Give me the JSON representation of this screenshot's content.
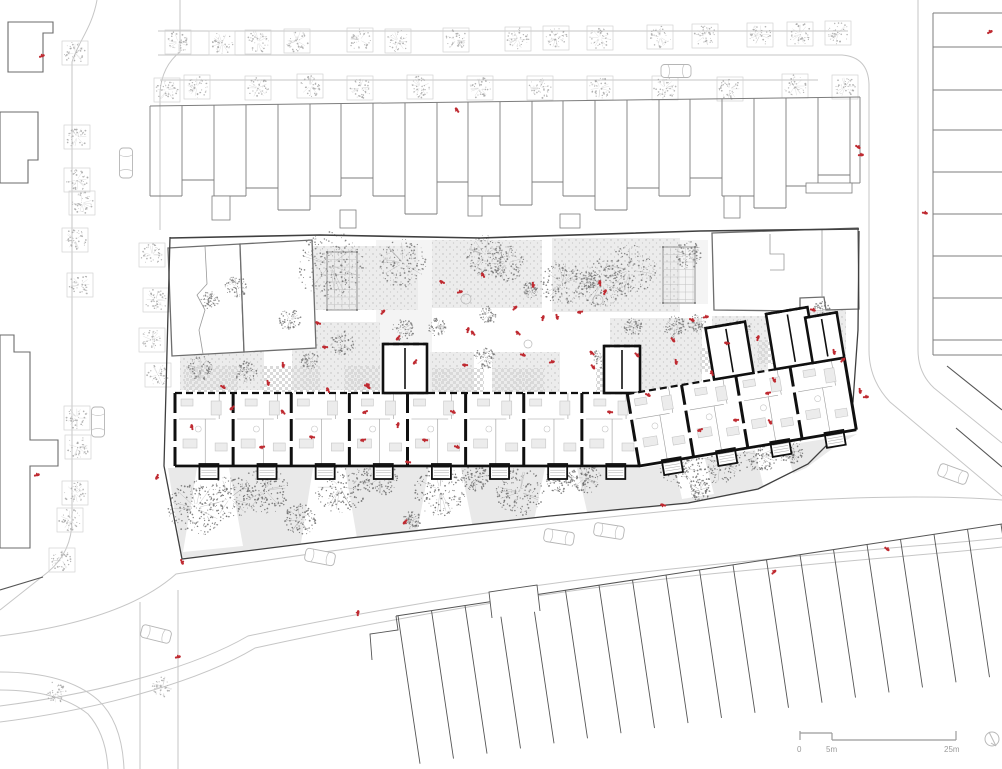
{
  "document": {
    "type": "architectural-site-plan",
    "view": "ground floor site plan"
  },
  "scale_bar": {
    "labels": [
      "0",
      "5m",
      "25m"
    ]
  },
  "north_arrow": {
    "symbol": "compass-circle"
  },
  "colors": {
    "paper": "#ffffff",
    "curb": "#c6c6c6",
    "context_stroke": "#7d7d7d",
    "context_dark": "#555555",
    "boundary": "#3f3f3f",
    "wall": "#101010",
    "interior_line": "#9c9c9c",
    "furniture_fill": "#ececec",
    "furniture_stroke": "#c6c6c6",
    "garden": "#e9e9e9",
    "plot_dot": "#bdbdbd",
    "checker": "#d9d9d9",
    "tree_street": "#a8a8a8",
    "tree_garden": "#787878",
    "accent_red": "#bf2a31",
    "scale_gray": "#9b9b9b"
  },
  "drawing": {
    "streets": {
      "light": [
        "M97,0 C92,28 78,42 72,62 V520 Q72,552 48,572 L0,610",
        "M180,0 V52 Q162,66 160,92 V230",
        "M158,31 H848",
        "M158,55 H842 Q868,57 869,84 V350 Q869,380 890,402 L1002,496",
        "M160,80 H818",
        "M918,0 V350 Q918,373 934,388 L1002,443",
        "M0,636 C80,626 140,606 176,574 C340,548 530,524 700,508 C850,494 950,496 1002,500",
        "M0,706 C110,692 200,664 248,636 C400,604 560,580 700,566 C850,550 950,544 1002,538",
        "M0,722 C110,708 205,678 255,648 C405,615 560,590 700,575 C850,560 950,553 1002,547",
        "M140,602 V769",
        "M178,590 V769",
        "M0,672 Q66,672 98,700 Q122,722 124,769",
        "M0,690 Q58,690 88,714 Q106,734 108,769"
      ],
      "dark": [
        "M947,366 L1002,410",
        "M956,428 L1002,467",
        "M43,577 L0,590"
      ]
    },
    "context": {
      "top_row": {
        "top_left": [
          150,
          106
        ],
        "top_right": [
          860,
          97
        ],
        "units": [
          [
            150,
            196
          ],
          [
            182,
            180
          ],
          [
            214,
            196
          ],
          [
            246,
            188
          ],
          [
            278,
            210
          ],
          [
            310,
            196
          ],
          [
            341,
            178
          ],
          [
            373,
            196
          ],
          [
            405,
            214
          ],
          [
            437,
            182
          ],
          [
            468,
            196
          ],
          [
            500,
            205
          ],
          [
            532,
            182
          ],
          [
            563,
            196
          ],
          [
            595,
            210
          ],
          [
            627,
            188
          ],
          [
            659,
            196
          ],
          [
            690,
            178
          ],
          [
            722,
            196
          ],
          [
            754,
            208
          ],
          [
            786,
            186
          ],
          [
            818,
            175
          ],
          [
            850,
            183
          ]
        ],
        "right_x": 860,
        "extensions": [
          [
            212,
            196,
            18,
            24
          ],
          [
            340,
            210,
            16,
            18
          ],
          [
            468,
            196,
            14,
            20
          ],
          [
            560,
            214,
            20,
            14
          ],
          [
            724,
            196,
            16,
            22
          ],
          [
            806,
            183,
            46,
            10
          ]
        ]
      },
      "left_buildings": [
        "M8,22 H53 V33 H43 V72 H8 Z",
        "M0,112 H38 V160 H28 V183 H0 Z",
        "M0,335 H14 V352 H30 V440 H58 V466 H30 V548 H0 Z"
      ],
      "right_strip": {
        "x": 933,
        "x2": 1002,
        "v_top": 13,
        "v_bottom": 355,
        "ys": [
          13,
          47,
          90,
          130,
          172,
          214,
          256,
          298,
          340,
          355
        ]
      },
      "bottom_row": {
        "front": [
          396,
          616,
          1002,
          524
        ],
        "count": 19,
        "step": 33.5,
        "drop": [
          22,
          148
        ],
        "bump": "M492,618 L489,592 L537,585 L540,611",
        "left_step": "M372,660 L370,634 L398,630 L396,616"
      }
    },
    "site": {
      "north_wall": "M170,238 L320,235 L480,238 L700,231 L859,229",
      "boundary": "M170,237 L164,466 L182,559 L350,538 L550,516 L688,503 L758,489 L808,464 L838,434 L853,402 L858,330 L859,231",
      "existing": [
        "M168,248 L240,244 L244,352 L172,356 Z",
        "M240,244 L312,240 L316,348 L244,352 Z",
        "M712,233 L858,228 L859,309 L826,310 L824,297 L800,298 L800,311 L714,310 Z"
      ],
      "existing_inner": [
        "M205,246 L207,284 L197,295 L205,310 L199,330 L203,354",
        "M822,229 L822,297",
        "M770,234 L770,254 L784,254 L784,270 L770,270"
      ],
      "pergolas": [
        [
          327,
          252,
          30,
          58
        ],
        [
          663,
          247,
          32,
          56
        ]
      ],
      "plots": [
        [
          238,
          246,
          180,
          64
        ],
        [
          432,
          240,
          110,
          68
        ],
        [
          552,
          238,
          128,
          74
        ],
        [
          180,
          302,
          84,
          88
        ],
        [
          292,
          322,
          88,
          68
        ],
        [
          430,
          352,
          44,
          40
        ],
        [
          492,
          352,
          68,
          40
        ],
        [
          610,
          318,
          92,
          72
        ],
        [
          712,
          316,
          56,
          56
        ],
        [
          772,
          310,
          74,
          46
        ]
      ],
      "pale": [
        [
          376,
          240,
          56,
          150
        ],
        [
          650,
          240,
          58,
          64
        ]
      ],
      "checkers": [
        [
          184,
          366,
          54,
          26
        ],
        [
          262,
          366,
          58,
          26
        ],
        [
          344,
          366,
          36,
          26
        ],
        [
          432,
          368,
          52,
          24
        ],
        [
          492,
          368,
          52,
          24
        ],
        [
          596,
          368,
          28,
          24
        ],
        [
          700,
          348,
          42,
          24
        ],
        [
          758,
          340,
          42,
          24
        ]
      ],
      "plaza_items": [
        [
          466,
          299,
          5
        ],
        [
          528,
          344,
          4
        ],
        [
          740,
          352,
          5
        ],
        [
          598,
          300,
          5
        ],
        [
          810,
          330,
          4
        ]
      ],
      "garden_poly": "M168,468 L640,468 L857,434 L836,446 L806,468 L758,490 L688,504 L550,517 L350,539 L182,558 Z",
      "garden_paths": [
        [
          197,
          468,
          229,
          468,
          243,
          546,
          183,
          552
        ],
        [
          313,
          468,
          345,
          468,
          357,
          538,
          301,
          543
        ],
        [
          429,
          468,
          461,
          468,
          473,
          528,
          417,
          533
        ],
        [
          545,
          468,
          577,
          468,
          589,
          520,
          533,
          525
        ],
        [
          672,
          452,
          702,
          448,
          714,
          494,
          682,
          499
        ],
        [
          753,
          441,
          783,
          436,
          795,
          480,
          763,
          485
        ]
      ]
    },
    "building": {
      "bandA": {
        "x": 175,
        "y": 393,
        "h": 73,
        "unit_w": 58.125,
        "n": 8,
        "towers": [
          [
            383,
            344,
            44,
            49
          ],
          [
            604,
            346,
            36,
            47
          ]
        ]
      },
      "bandB": {
        "rotate": -9.5,
        "cx": 640,
        "cy": 470,
        "x": 640,
        "y": 393,
        "h": 73,
        "unit_w": 55,
        "n": 4,
        "towers": [
          [
            728,
            341,
            40,
            52
          ],
          [
            790,
            337,
            42,
            56
          ],
          [
            828,
            347,
            32,
            46
          ]
        ]
      }
    },
    "trees": {
      "street_groups": [
        {
          "planter": true,
          "pts": [
            [
              178,
              42
            ],
            [
              222,
              43
            ],
            [
              258,
              42
            ],
            [
              297,
              41
            ],
            [
              360,
              40
            ],
            [
              398,
              41
            ],
            [
              456,
              40
            ],
            [
              518,
              39
            ],
            [
              556,
              38
            ],
            [
              600,
              38
            ],
            [
              660,
              37
            ],
            [
              705,
              36
            ],
            [
              760,
              35
            ],
            [
              800,
              34
            ],
            [
              838,
              33
            ]
          ]
        },
        {
          "planter": true,
          "pts": [
            [
              167,
              90
            ],
            [
              197,
              87
            ],
            [
              258,
              88
            ],
            [
              310,
              86
            ],
            [
              360,
              88
            ],
            [
              420,
              87
            ],
            [
              480,
              88
            ],
            [
              540,
              88
            ],
            [
              600,
              88
            ],
            [
              665,
              88
            ],
            [
              730,
              89
            ],
            [
              795,
              86
            ],
            [
              845,
              87
            ]
          ]
        },
        {
          "planter": true,
          "pts": [
            [
              75,
              53
            ],
            [
              77,
              137
            ],
            [
              77,
              180
            ],
            [
              82,
              203
            ],
            [
              75,
              240
            ],
            [
              80,
              285
            ],
            [
              77,
              418
            ],
            [
              78,
              447
            ],
            [
              75,
              493
            ],
            [
              70,
              520
            ],
            [
              62,
              560
            ]
          ]
        },
        {
          "planter": true,
          "pts": [
            [
              152,
              255
            ],
            [
              156,
              300
            ],
            [
              152,
              340
            ],
            [
              158,
              375
            ]
          ]
        },
        {
          "planter": false,
          "pts": [
            [
              55,
              693
            ],
            [
              163,
              686
            ]
          ]
        }
      ],
      "courtyard": [
        [
          330,
          265,
          34
        ],
        [
          403,
          263,
          24
        ],
        [
          485,
          255,
          20
        ],
        [
          507,
          263,
          18
        ],
        [
          563,
          283,
          22
        ],
        [
          602,
          283,
          24
        ],
        [
          630,
          270,
          26
        ],
        [
          688,
          255,
          14
        ],
        [
          343,
          343,
          12
        ],
        [
          403,
          330,
          11
        ],
        [
          437,
          327,
          9
        ],
        [
          485,
          358,
          11
        ],
        [
          488,
          315,
          9
        ],
        [
          602,
          358,
          10
        ],
        [
          633,
          327,
          9
        ],
        [
          675,
          327,
          11
        ],
        [
          697,
          323,
          9
        ],
        [
          593,
          280,
          9
        ],
        [
          236,
          287,
          11
        ],
        [
          210,
          300,
          9
        ],
        [
          290,
          320,
          11
        ],
        [
          740,
          330,
          11
        ],
        [
          800,
          318,
          11
        ],
        [
          822,
          310,
          9
        ],
        [
          200,
          368,
          12
        ],
        [
          246,
          372,
          11
        ],
        [
          310,
          360,
          9
        ],
        [
          530,
          290,
          8
        ]
      ],
      "garden": [
        [
          196,
          508,
          28
        ],
        [
          230,
          498,
          22
        ],
        [
          265,
          490,
          24
        ],
        [
          340,
          487,
          26
        ],
        [
          300,
          520,
          16
        ],
        [
          380,
          478,
          18
        ],
        [
          440,
          490,
          26
        ],
        [
          475,
          478,
          14
        ],
        [
          520,
          492,
          24
        ],
        [
          560,
          480,
          14
        ],
        [
          585,
          478,
          16
        ],
        [
          680,
          468,
          20
        ],
        [
          720,
          462,
          22
        ],
        [
          760,
          455,
          18
        ],
        [
          790,
          450,
          14
        ],
        [
          700,
          490,
          11
        ],
        [
          412,
          520,
          9
        ]
      ]
    },
    "cars": [
      [
        126,
        163,
        90
      ],
      [
        98,
        422,
        90
      ],
      [
        676,
        71,
        0
      ],
      [
        156,
        634,
        14
      ],
      [
        559,
        537,
        9
      ],
      [
        609,
        531,
        9
      ],
      [
        320,
        557,
        11
      ],
      [
        953,
        474,
        20
      ]
    ],
    "people": [
      [
        42,
        56
      ],
      [
        457,
        110
      ],
      [
        990,
        32
      ],
      [
        858,
        147
      ],
      [
        861,
        155
      ],
      [
        925,
        213
      ],
      [
        37,
        475
      ],
      [
        157,
        477
      ],
      [
        182,
        562
      ],
      [
        178,
        657
      ],
      [
        405,
        522
      ],
      [
        358,
        613
      ],
      [
        663,
        505
      ],
      [
        774,
        572
      ],
      [
        887,
        549
      ],
      [
        318,
        323
      ],
      [
        325,
        347
      ],
      [
        383,
        312
      ],
      [
        398,
        338
      ],
      [
        367,
        385
      ],
      [
        415,
        362
      ],
      [
        442,
        282
      ],
      [
        460,
        292
      ],
      [
        483,
        275
      ],
      [
        468,
        330
      ],
      [
        473,
        333
      ],
      [
        465,
        365
      ],
      [
        518,
        333
      ],
      [
        523,
        355
      ],
      [
        533,
        285
      ],
      [
        515,
        308
      ],
      [
        543,
        318
      ],
      [
        557,
        317
      ],
      [
        580,
        312
      ],
      [
        592,
        353
      ],
      [
        593,
        367
      ],
      [
        552,
        362
      ],
      [
        600,
        283
      ],
      [
        605,
        292
      ],
      [
        637,
        355
      ],
      [
        673,
        340
      ],
      [
        692,
        320
      ],
      [
        706,
        317
      ],
      [
        223,
        387
      ],
      [
        268,
        383
      ],
      [
        328,
        390
      ],
      [
        283,
        365
      ],
      [
        368,
        387
      ],
      [
        232,
        408
      ],
      [
        192,
        427
      ],
      [
        283,
        412
      ],
      [
        365,
        412
      ],
      [
        262,
        447
      ],
      [
        312,
        437
      ],
      [
        363,
        440
      ],
      [
        398,
        425
      ],
      [
        408,
        462
      ],
      [
        425,
        440
      ],
      [
        453,
        412
      ],
      [
        610,
        412
      ],
      [
        648,
        395
      ],
      [
        676,
        362
      ],
      [
        736,
        420
      ],
      [
        700,
        430
      ],
      [
        712,
        373
      ],
      [
        727,
        343
      ],
      [
        758,
        338
      ],
      [
        768,
        393
      ],
      [
        774,
        380
      ],
      [
        770,
        422
      ],
      [
        813,
        310
      ],
      [
        834,
        352
      ],
      [
        843,
        360
      ],
      [
        860,
        391
      ],
      [
        866,
        397
      ],
      [
        457,
        447
      ]
    ]
  }
}
